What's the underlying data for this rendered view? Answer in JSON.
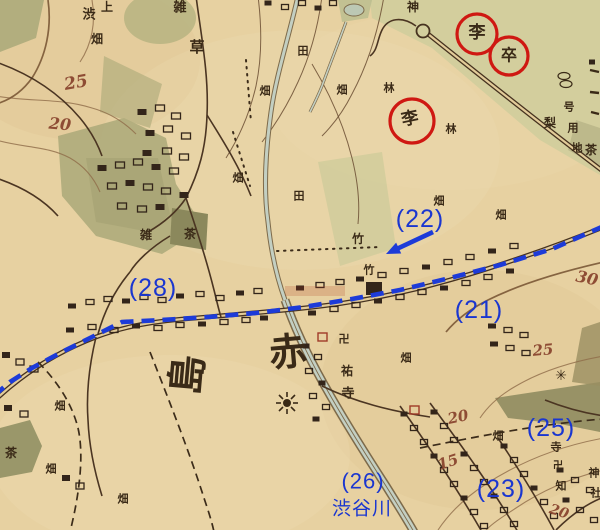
{
  "map": {
    "colors": {
      "paper": "#e7d1a1",
      "ink": "#3a2a17",
      "contour_number_red": "#8e4c34",
      "annotation_blue": "#1a36d0",
      "annotation_red": "#cf1812",
      "field_green": "#d0cd9c",
      "grove_olive": "#aeab7b",
      "stream": "#c3cfc2"
    },
    "blue_labels": [
      {
        "text": "(22)",
        "x": 420,
        "y": 219,
        "size": 25
      },
      {
        "text": "(21)",
        "x": 479,
        "y": 310,
        "size": 25
      },
      {
        "text": "(28)",
        "x": 153,
        "y": 288,
        "size": 25
      },
      {
        "text": "(25)",
        "x": 551,
        "y": 428,
        "size": 25
      },
      {
        "text": "(23)",
        "x": 501,
        "y": 489,
        "size": 25
      },
      {
        "text": "(26)",
        "x": 363,
        "y": 481,
        "size": 22
      },
      {
        "text": "渋谷川",
        "x": 362,
        "y": 509,
        "size": 19
      }
    ],
    "arrow": {
      "x1": 433,
      "y1": 232,
      "x2": 386,
      "y2": 254
    },
    "route_points": [
      [
        604,
        226
      ],
      [
        552,
        249
      ],
      [
        500,
        265
      ],
      [
        450,
        278
      ],
      [
        400,
        290
      ],
      [
        352,
        299
      ],
      [
        304,
        307
      ],
      [
        256,
        313
      ],
      [
        208,
        317
      ],
      [
        162,
        320
      ],
      [
        122,
        322
      ],
      [
        90,
        338
      ],
      [
        60,
        353
      ],
      [
        32,
        368
      ],
      [
        10,
        382
      ],
      [
        -4,
        394
      ]
    ],
    "red_circles": [
      {
        "cx": 477,
        "cy": 34,
        "r": 20
      },
      {
        "cx": 509,
        "cy": 56,
        "r": 19
      },
      {
        "cx": 412,
        "cy": 121,
        "r": 22
      }
    ],
    "circled_chars": [
      {
        "text": "李",
        "x": 477,
        "y": 33,
        "size": 17
      },
      {
        "text": "卒",
        "x": 509,
        "y": 55,
        "size": 16
      },
      {
        "text": "李",
        "x": 410,
        "y": 119,
        "size": 17,
        "rot": -12
      }
    ],
    "contour_numbers": [
      {
        "text": "25",
        "x": 76,
        "y": 83,
        "size": 17,
        "rot": -10
      },
      {
        "text": "20",
        "x": 60,
        "y": 124,
        "size": 16,
        "rot": 5
      },
      {
        "text": "30",
        "x": 587,
        "y": 278,
        "size": 16,
        "rot": 12
      },
      {
        "text": "25",
        "x": 543,
        "y": 350,
        "size": 15,
        "rot": -5
      },
      {
        "text": "20",
        "x": 458,
        "y": 417,
        "size": 15,
        "rot": -12
      },
      {
        "text": "15",
        "x": 448,
        "y": 462,
        "size": 15,
        "rot": -18
      },
      {
        "text": "20",
        "x": 559,
        "y": 512,
        "size": 14,
        "rot": 18
      }
    ],
    "kanji_labels": [
      {
        "text": "上",
        "x": 107,
        "y": 7,
        "size": 12
      },
      {
        "text": "渋",
        "x": 89,
        "y": 15,
        "size": 13
      },
      {
        "text": "畑",
        "x": 97,
        "y": 39,
        "size": 12
      },
      {
        "text": "雑",
        "x": 180,
        "y": 8,
        "size": 13
      },
      {
        "text": "草",
        "x": 197,
        "y": 47,
        "size": 15
      },
      {
        "text": "神",
        "x": 413,
        "y": 7,
        "size": 12
      },
      {
        "text": "田",
        "x": 303,
        "y": 51,
        "size": 11
      },
      {
        "text": "畑",
        "x": 265,
        "y": 91,
        "size": 11
      },
      {
        "text": "畑",
        "x": 342,
        "y": 90,
        "size": 11
      },
      {
        "text": "林",
        "x": 389,
        "y": 88,
        "size": 11
      },
      {
        "text": "林",
        "x": 451,
        "y": 129,
        "size": 11
      },
      {
        "text": "梨",
        "x": 550,
        "y": 123,
        "size": 12
      },
      {
        "text": "茶",
        "x": 591,
        "y": 150,
        "size": 12
      },
      {
        "text": "畑",
        "x": 238,
        "y": 178,
        "size": 11
      },
      {
        "text": "田",
        "x": 299,
        "y": 196,
        "size": 11
      },
      {
        "text": "竹",
        "x": 358,
        "y": 239,
        "size": 12
      },
      {
        "text": "竹",
        "x": 369,
        "y": 270,
        "size": 11
      },
      {
        "text": "雑",
        "x": 146,
        "y": 235,
        "size": 12
      },
      {
        "text": "茶",
        "x": 190,
        "y": 234,
        "size": 12
      },
      {
        "text": "畑",
        "x": 439,
        "y": 201,
        "size": 11
      },
      {
        "text": "畑",
        "x": 501,
        "y": 215,
        "size": 11
      },
      {
        "text": "赤",
        "x": 288,
        "y": 352,
        "size": 38,
        "rot": -5
      },
      {
        "text": "島",
        "x": 188,
        "y": 375,
        "size": 40,
        "rot": -85
      },
      {
        "text": "卍",
        "x": 344,
        "y": 339,
        "size": 11
      },
      {
        "text": "祐",
        "x": 347,
        "y": 371,
        "size": 12
      },
      {
        "text": "寺",
        "x": 348,
        "y": 394,
        "size": 13
      },
      {
        "text": "畑",
        "x": 406,
        "y": 358,
        "size": 11
      },
      {
        "text": "畑",
        "x": 60,
        "y": 406,
        "size": 11
      },
      {
        "text": "畑",
        "x": 51,
        "y": 469,
        "size": 11
      },
      {
        "text": "畑",
        "x": 123,
        "y": 499,
        "size": 11
      },
      {
        "text": "畑",
        "x": 498,
        "y": 436,
        "size": 11
      },
      {
        "text": "茶",
        "x": 11,
        "y": 453,
        "size": 12
      },
      {
        "text": "✳",
        "x": 561,
        "y": 376,
        "size": 14
      },
      {
        "text": "号",
        "x": 569,
        "y": 107,
        "size": 11
      },
      {
        "text": "用",
        "x": 573,
        "y": 128,
        "size": 11
      },
      {
        "text": "地",
        "x": 577,
        "y": 148,
        "size": 11
      },
      {
        "text": "寺",
        "x": 556,
        "y": 447,
        "size": 11
      },
      {
        "text": "卍",
        "x": 558,
        "y": 466,
        "size": 10
      },
      {
        "text": "知",
        "x": 561,
        "y": 486,
        "size": 11
      },
      {
        "text": "神",
        "x": 594,
        "y": 473,
        "size": 11
      },
      {
        "text": "社",
        "x": 596,
        "y": 493,
        "size": 11
      }
    ]
  }
}
